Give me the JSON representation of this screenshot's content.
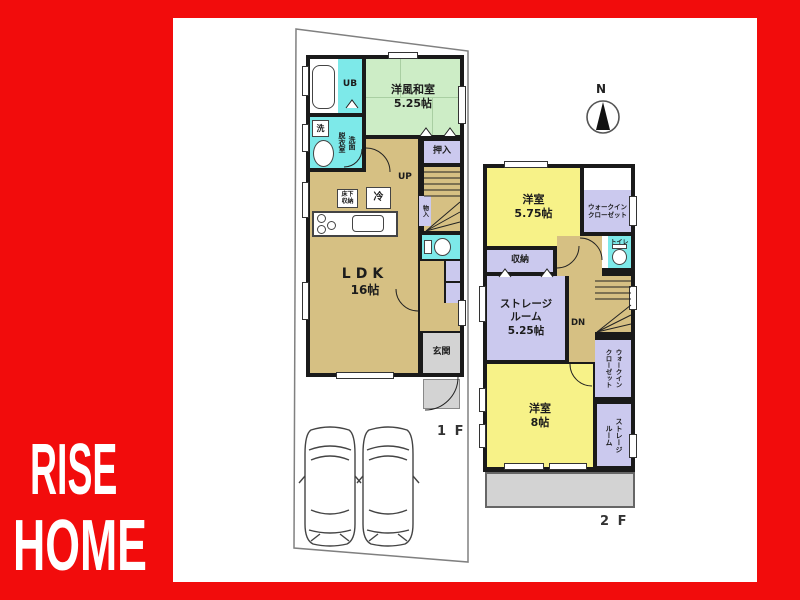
{
  "brand": {
    "line1": "RISE",
    "line2": "HOME"
  },
  "compass": {
    "north_label": "N"
  },
  "floor1": {
    "floor_label": "1 F",
    "unit_bath": "UB",
    "washer": "洗",
    "washroom_col_left": "脱衣室",
    "washroom_col_right": "洗面",
    "washitsu_name": "洋風和室",
    "washitsu_size": "5.25帖",
    "oshiire": "押入",
    "monoire": "物入",
    "up": "UP",
    "fridge": "冷",
    "underfloor_l1": "床下",
    "underfloor_l2": "収納",
    "ldk_name": "LDK",
    "ldk_size": "16帖",
    "genkan": "玄関"
  },
  "floor2": {
    "floor_label": "2 F",
    "bedroom1_name": "洋室",
    "bedroom1_size": "5.75帖",
    "wic_top_l1": "ウォークイン",
    "wic_top_l2": "クローゼット",
    "toilet": "トイレ",
    "closet": "収納",
    "storage_room_l1": "ストレージ",
    "storage_room_l2": "ルーム",
    "storage_room_size": "5.25帖",
    "down": "DN",
    "wic_mid_col_left": "クローゼット",
    "wic_mid_col_right": "ウォークイン",
    "bedroom2_name": "洋室",
    "bedroom2_size": "8帖",
    "storage_small_col_left": "ルーム",
    "storage_small_col_right": "ストレージ"
  },
  "colors": {
    "brand_red": "#F20C0C",
    "wall": "#1A1A1A",
    "room_tan": "#D6C083",
    "room_green": "#CDEDC6",
    "room_cyan": "#7DE9E9",
    "room_lavender": "#CBC9EE",
    "room_yellow": "#F7F288",
    "room_gray": "#D3D3D3"
  }
}
